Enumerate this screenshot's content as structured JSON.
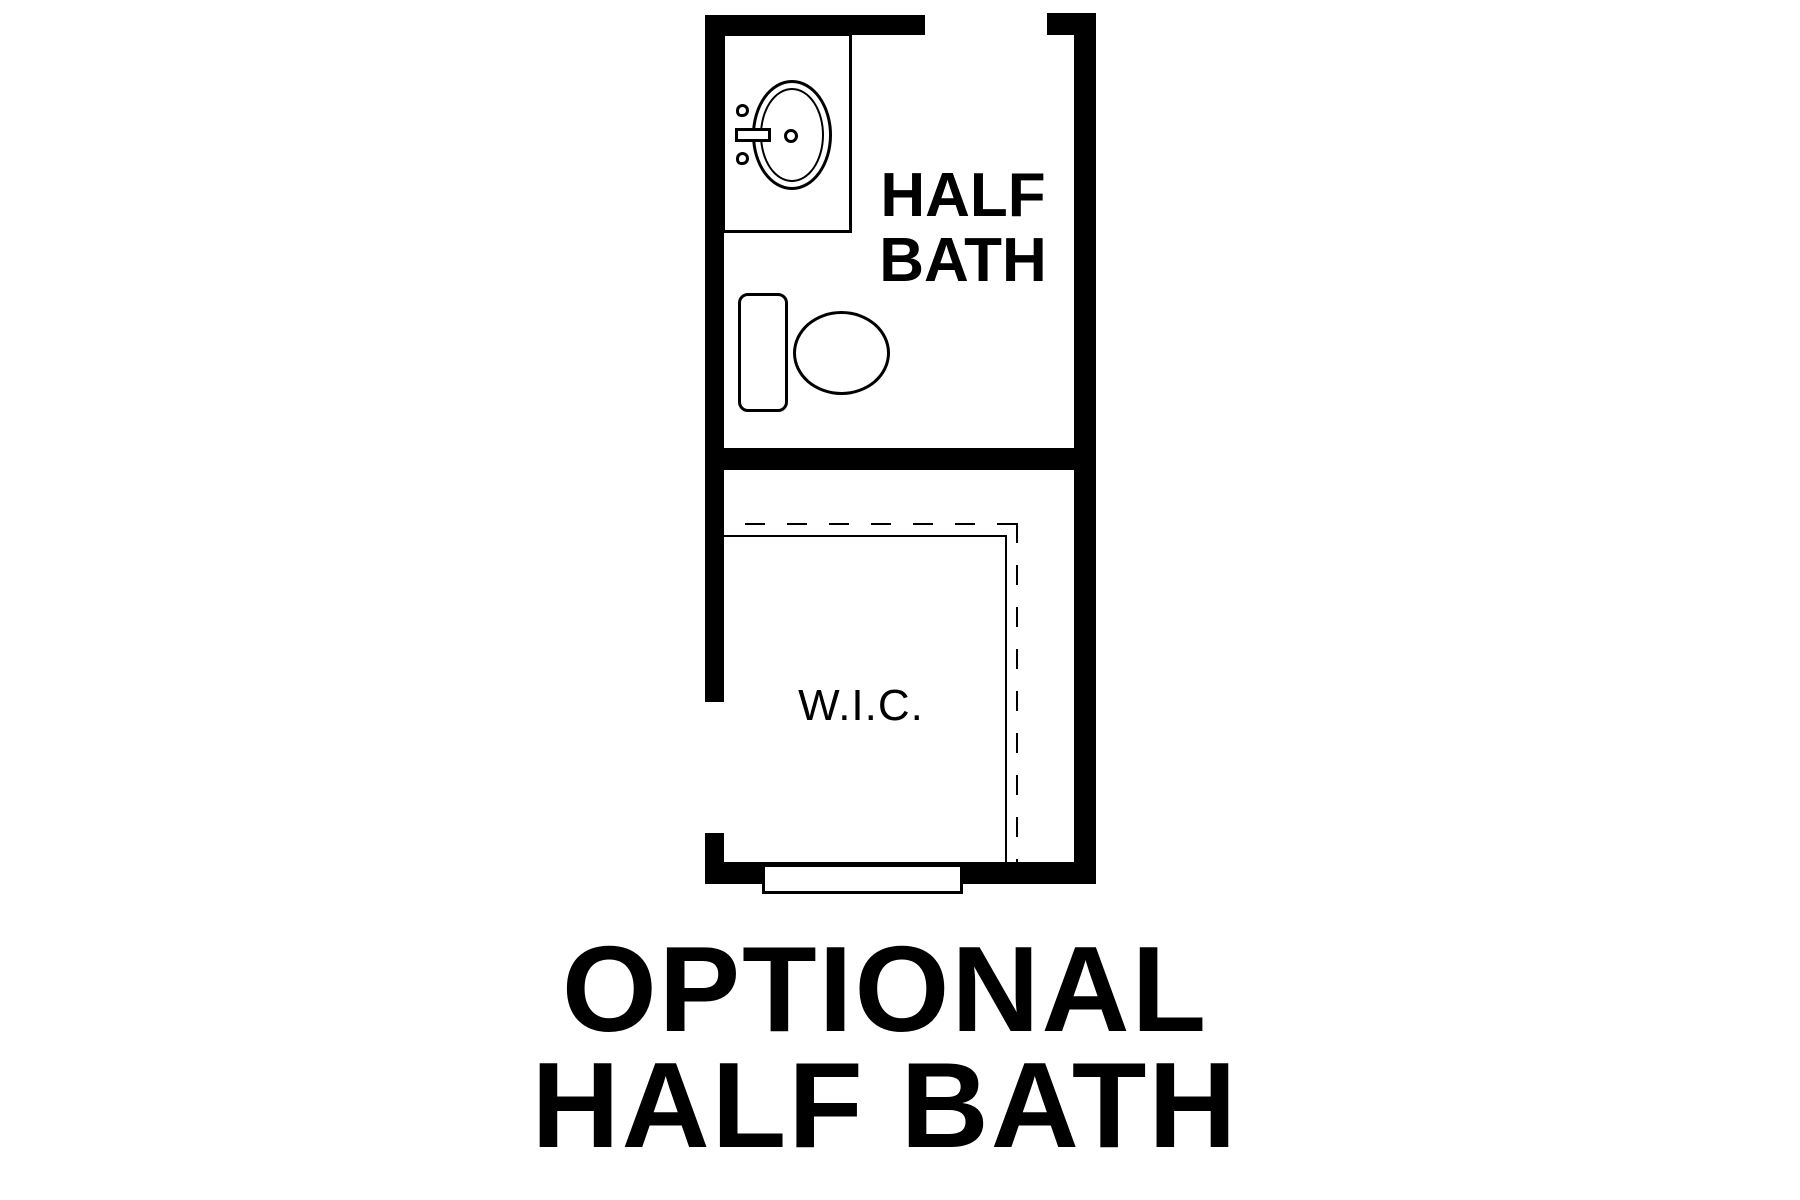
{
  "colors": {
    "background": "#ffffff",
    "ink": "#000000"
  },
  "plan": {
    "half_bath": {
      "label": [
        "HALF",
        "BATH"
      ]
    },
    "wic": {
      "label": "W.I.C."
    },
    "fixture_icons": [
      "sink-vanity-icon",
      "toilet-icon",
      "door-opening",
      "closet-shelf-dashed-line"
    ]
  },
  "caption": {
    "lines": [
      "OPTIONAL",
      "HALF BATH"
    ]
  }
}
